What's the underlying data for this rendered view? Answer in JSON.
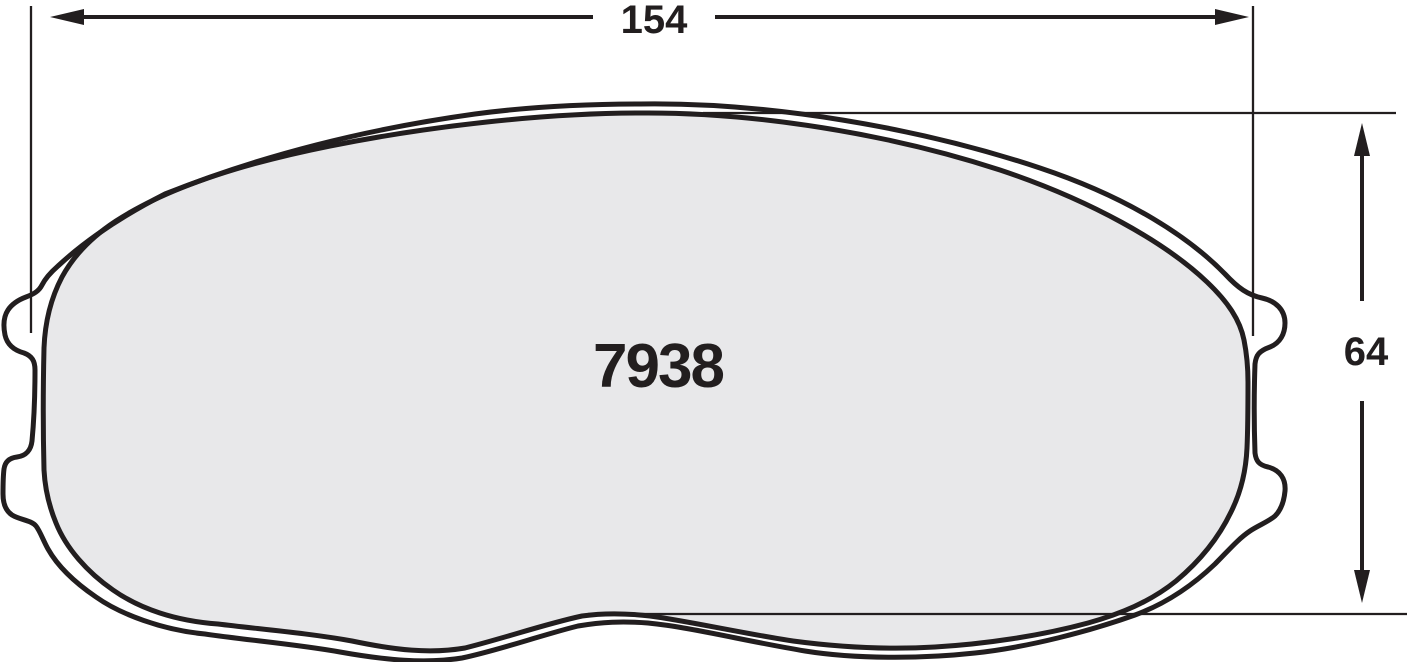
{
  "drawing": {
    "part_number": "7938",
    "width_dimension": "154",
    "height_dimension": "64",
    "colors": {
      "outline": "#221e1f",
      "friction_fill": "#e8e8ea",
      "background": "#ffffff"
    }
  }
}
